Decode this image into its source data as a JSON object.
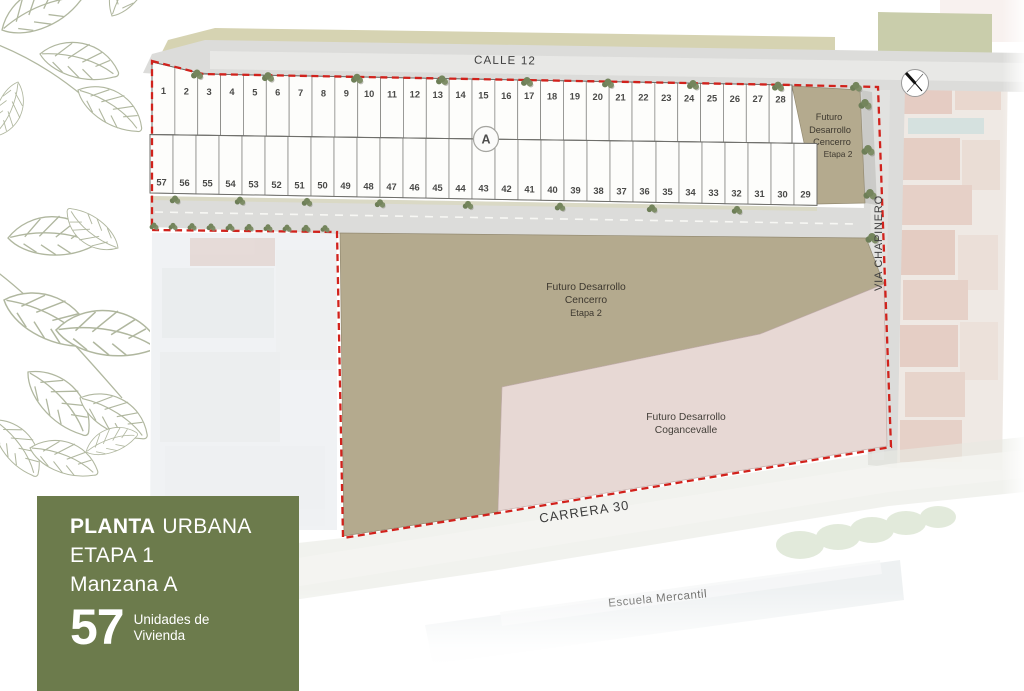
{
  "panel": {
    "title_bold": "PLANTA",
    "title_light": "URBANA",
    "etapa": "ETAPA 1",
    "manzana": "Manzana A",
    "units_count": "57",
    "units_line1": "Unidades de",
    "units_line2": "Vivienda"
  },
  "map": {
    "street_calle": "CALLE 12",
    "street_carrera": "CARRERA 30",
    "street_via": "VIA CHAPINERO",
    "escuela_label": "Escuela Mercantil",
    "block_marker": "A",
    "tan_small_label": [
      "Futuro",
      "Desarrollo",
      "Cencerro",
      "Etapa 2"
    ],
    "tan_large_label": [
      "Futuro Desarrollo",
      "Cencerro",
      "Etapa 2"
    ],
    "pink_label": [
      "Futuro Desarrollo",
      "Cogancevalle"
    ],
    "lots_top": [
      1,
      2,
      3,
      4,
      5,
      6,
      7,
      8,
      9,
      10,
      11,
      12,
      13,
      14,
      15,
      16,
      17,
      18,
      19,
      20,
      21,
      22,
      23,
      24,
      25,
      26,
      27,
      28
    ],
    "lots_bottom": [
      57,
      56,
      55,
      54,
      53,
      52,
      51,
      50,
      49,
      48,
      47,
      46,
      45,
      44,
      43,
      42,
      41,
      40,
      39,
      38,
      37,
      36,
      35,
      34,
      33,
      32,
      31,
      30,
      29
    ]
  },
  "colors": {
    "boundary_red": "#d1221c",
    "parcel_tan": "#b4aa8e",
    "parcel_pink": "#e7d8d4",
    "panel_green": "#6c7b4c",
    "road_gray": "#dcdcda",
    "grass_khaki": "#d6d3b2"
  }
}
